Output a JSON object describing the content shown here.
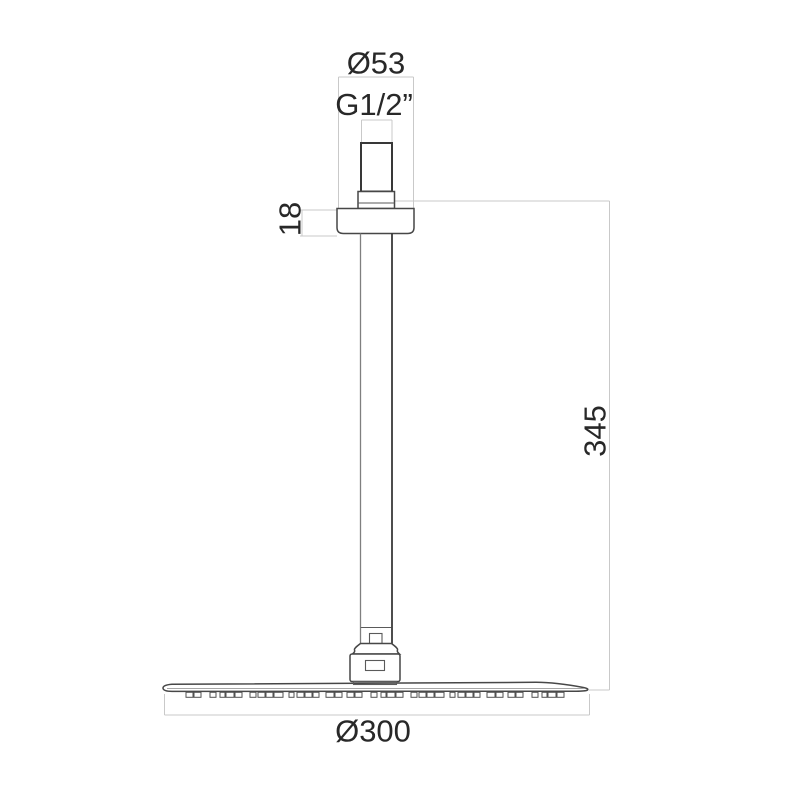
{
  "drawing": {
    "type": "technical-dimension-drawing",
    "subject": "Ceiling-mounted shower head with vertical arm, side elevation",
    "labels": {
      "top_diameter": "Ø53",
      "thread_size": "G1/2”",
      "escutcheon_height": "18",
      "arm_length": "345",
      "head_width": "Ø300"
    },
    "colors": {
      "background": "#ffffff",
      "outline_dark": "#383838",
      "outline_medium": "#6f6f6f",
      "dimension_lines": "#c9c9c9",
      "text": "#282828"
    },
    "nozzles": {
      "start_x": 186,
      "end_x": 572,
      "y": 692.3,
      "height": 5,
      "widths": [
        7,
        7,
        6,
        5,
        8,
        7,
        6,
        7,
        7,
        9,
        5,
        7,
        7,
        6,
        8,
        7
      ],
      "gaps": [
        1,
        9,
        4,
        1,
        1,
        8,
        2,
        1,
        1,
        6,
        3,
        1,
        1,
        7,
        1,
        5
      ]
    }
  }
}
